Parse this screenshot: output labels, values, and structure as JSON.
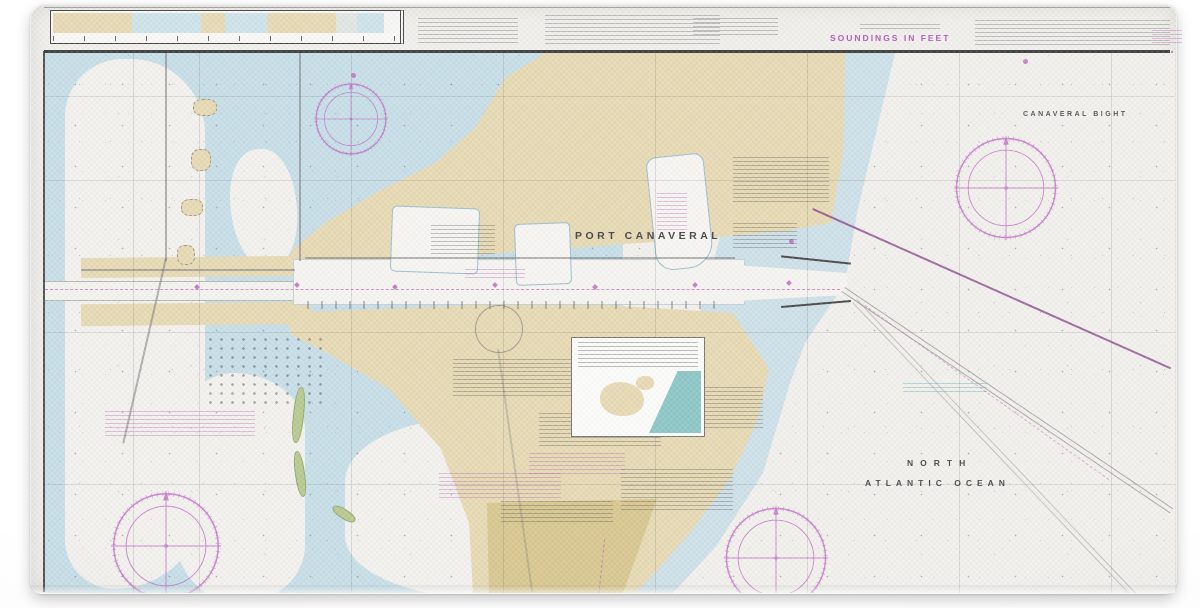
{
  "product_photo": {
    "background_color": "#fcfcfc",
    "subject": "nautical chart print"
  },
  "chart": {
    "margin": {
      "soundings_note": "SOUNDINGS IN FEET"
    },
    "labels": {
      "port": "PORT CANAVERAL",
      "bight": "CANAVERAL BIGHT",
      "ocean_line1": "NORTH",
      "ocean_line2": "ATLANTIC OCEAN",
      "cape": "CAPE CANAVERAL"
    },
    "colors": {
      "land_tan": "#e8dbb6",
      "cape_khaki": "#d8c68e",
      "lagoon_blue": "#c9e0e9",
      "nearshore_blue": "#cfe2ea",
      "ocean_white": "#f3f2ee",
      "magenta": "#bd66bd",
      "cable_purple": "#803484",
      "spoil_green": "#b9cb92",
      "inset_teal": "#8fc8c8",
      "neatline_black": "#2c2c2c"
    },
    "symbols": {
      "compass_roses": 4,
      "channel_buoys": 7
    }
  }
}
